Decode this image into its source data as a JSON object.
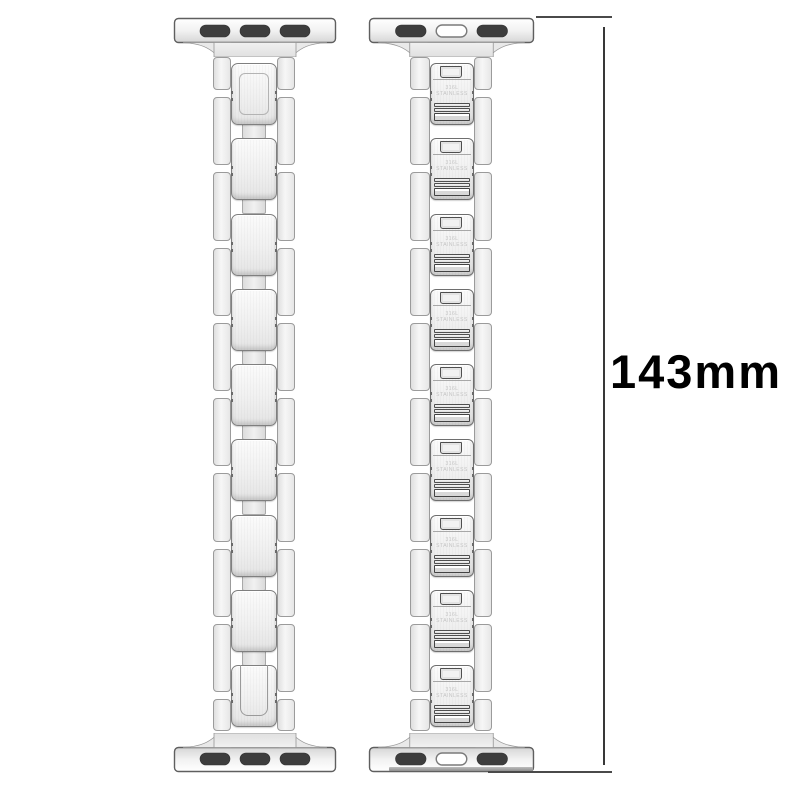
{
  "scene_title": "stainless steel link watch band - front and back views with length dimension",
  "measurement": {
    "label": "143mm"
  },
  "band_front": {
    "view": "front",
    "links": 9,
    "adapter_slots": 3
  },
  "band_back": {
    "view": "back",
    "links": 9,
    "adapter_slots": 3,
    "engraving": [
      "316L",
      "STAINLESS"
    ]
  },
  "colors": {
    "background": "#ffffff",
    "metal_highlight": "#fbfbfb",
    "metal_mid": "#efefef",
    "metal_shadow": "#d9d9d9",
    "outline": "#7f7f7f",
    "outline_dark": "#4f4f4f",
    "slot_dark": "#3d3d3d",
    "slot_open": "#ffffff",
    "measure_line": "#383838",
    "label_text": "#000000",
    "engraving": "#c4c4c4"
  }
}
